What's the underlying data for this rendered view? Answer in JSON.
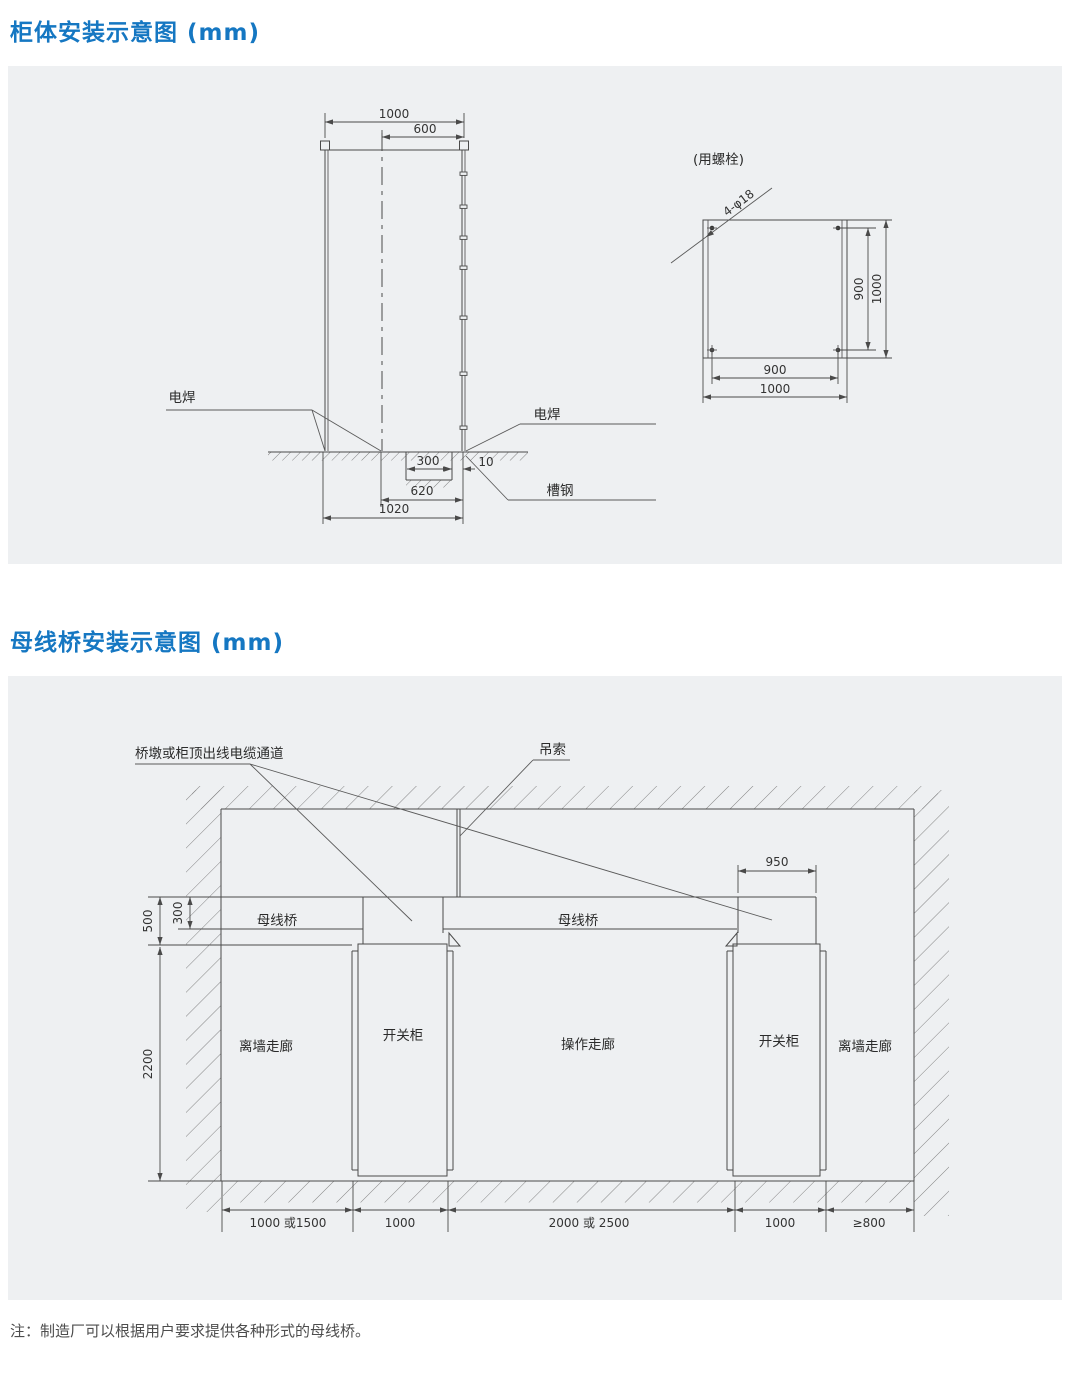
{
  "page": {
    "accent_color": "#1577c2",
    "panel_bg": "#eef0f2",
    "title_cabinet": "柜体安装示意图 (mm)",
    "title_busbar": "母线桥安装示意图 (mm)",
    "note": "注：制造厂可以根据用户要求提供各种形式的母线桥。"
  },
  "cabinet_diagram": {
    "front_view": {
      "dim_width_top": "1000",
      "dim_center_to_right": "600",
      "label_weld_left": "电焊",
      "label_weld_right": "电焊",
      "label_channel_steel": "槽钢",
      "dim_recess_width": "300",
      "dim_edge_gap": "10",
      "dim_center_to_edge": "620",
      "dim_base_span": "1020"
    },
    "plan_view": {
      "label_bolt_method": "(用螺栓)",
      "label_bolt_holes": "4-φ18",
      "dim_bolt_spacing_h": "900",
      "dim_width_h": "1000",
      "dim_bolt_spacing_v": "900",
      "dim_depth_v": "1000"
    }
  },
  "busbar_diagram": {
    "label_cable_channel": "桥墩或柜顶出线电缆通道",
    "label_sling": "吊索",
    "label_bridge_left": "母线桥",
    "label_bridge_right": "母线桥",
    "label_corridor_left": "离墙走廊",
    "label_cabinet_left": "开关柜",
    "label_corridor_center": "操作走廊",
    "label_cabinet_right": "开关柜",
    "label_corridor_right": "离墙走廊",
    "dim_riser_width": "950",
    "dim_bridge_drop": "500",
    "dim_bridge_height": "300",
    "dim_cabinet_height": "2200",
    "spans": [
      "1000 或1500",
      "1000",
      "2000 或 2500",
      "1000",
      "≥800"
    ]
  }
}
